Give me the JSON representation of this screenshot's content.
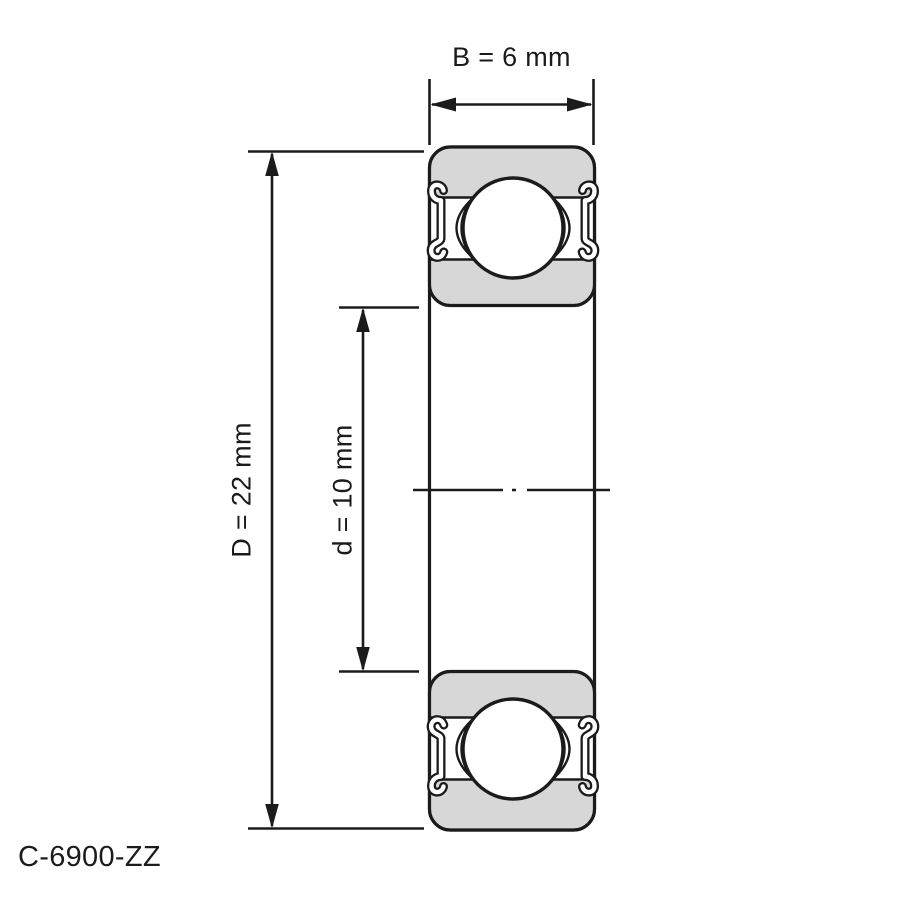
{
  "drawing": {
    "part_number": "C-6900-ZZ",
    "dimensions": {
      "width": {
        "symbol": "B",
        "value": "6",
        "unit": "mm",
        "label": "B = 6 mm"
      },
      "outer_diameter": {
        "symbol": "D",
        "value": "22",
        "unit": "mm",
        "label": "D = 22 mm"
      },
      "bore_diameter": {
        "symbol": "d",
        "value": "10",
        "unit": "mm",
        "label": "d = 10 mm"
      }
    },
    "colors": {
      "line": "#1b1b1b",
      "ring_fill": "#d7d7d7",
      "background": "#ffffff"
    }
  }
}
